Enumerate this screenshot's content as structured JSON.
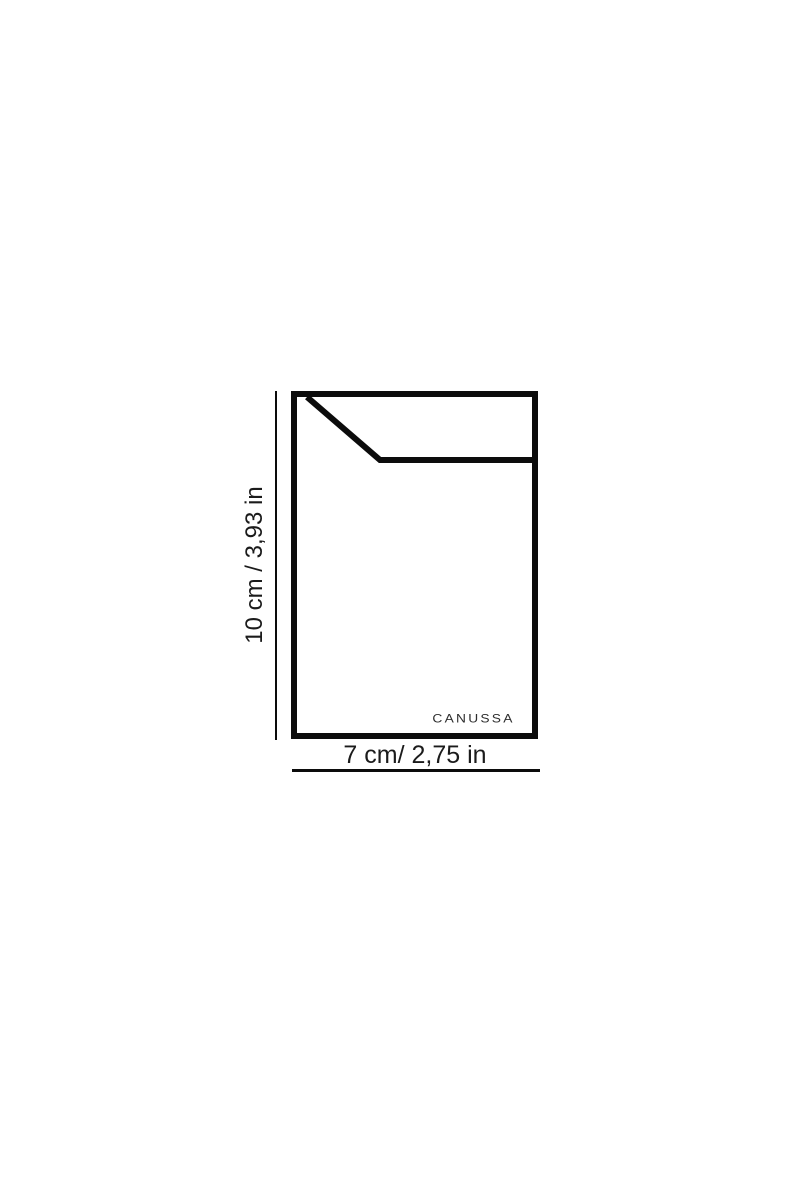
{
  "page": {
    "background_color": "#ffffff"
  },
  "diagram": {
    "brand_logo": "CANUSSA",
    "height_dimension": {
      "label": "10 cm / 3,93 in",
      "value_cm": "10",
      "value_in": "3,93"
    },
    "width_dimension": {
      "label": "7 cm/ 2,75 in",
      "value_cm": "7",
      "value_in": "2,75"
    },
    "colors": {
      "outline": "#0c0c0c",
      "label_text": "#1b1b1b",
      "brand_text": "#2e2e2e"
    }
  }
}
